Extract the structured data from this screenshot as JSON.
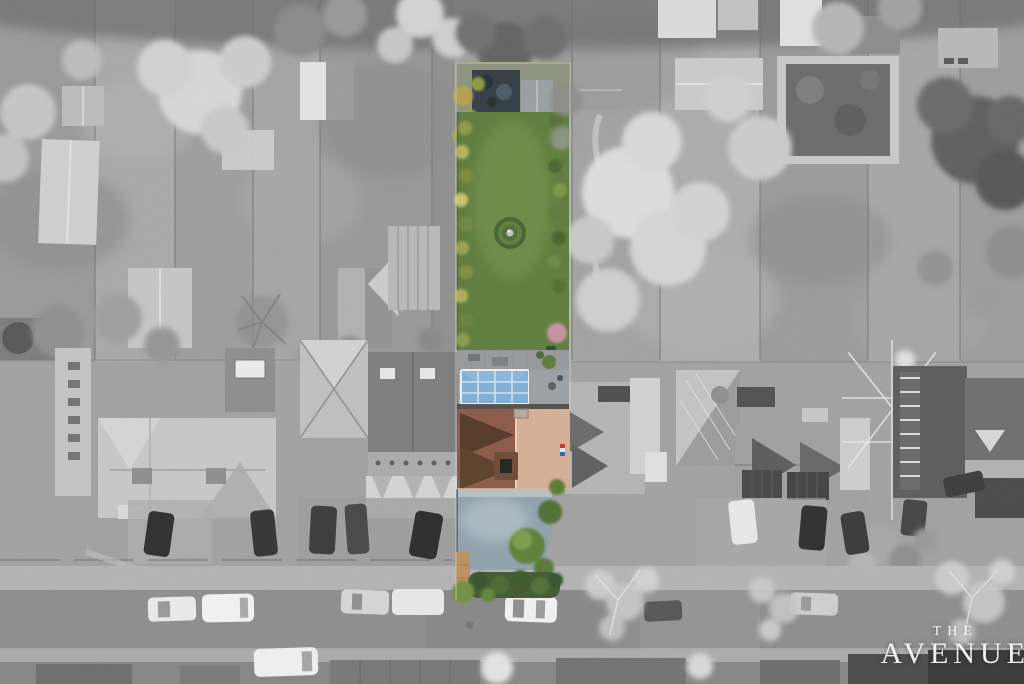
{
  "meta": {
    "type": "aerial-drone-photograph",
    "style": "selective-colour listing photo",
    "description": "Top-down winter aerial photo of a residential street. Everything is desaturated greyscale except one highlighted property: a long narrow plot with rear shed, large green lawn with circular flower bed, patio, blue-glazed conservatory, terracotta-roofed house, blue-grey driveway and front hedge, ending at the road with parked cars.",
    "width": 1024,
    "height": 684
  },
  "watermark": {
    "line1": "THE",
    "line2": "AVENUE"
  },
  "palette": {
    "mono_base": "#a2a2a2",
    "road": "#8e8e8e",
    "pavement": "#b4b4b4",
    "lawn": "#5e7d3c",
    "lawn_light": "#74924c",
    "hedge": "#42592e",
    "bush": "#5d8038",
    "shrub_yellow": "#b5b15c",
    "roof_dark_gable": "#553828",
    "roof_shadow_side": "#8a5a46",
    "roof_sunlit_side": "#d6b096",
    "conservatory_glass": "#7fb0d6",
    "driveway": "#8ea2ae",
    "wood_fence": "#bb9160",
    "car_white": "#f2f2f2",
    "car_dark": "#2f2f2f",
    "tree_bright": "#d6d6d6",
    "tree_dark": "#636363"
  },
  "property": {
    "label": "highlighted property plot",
    "features": "rear shed and patio, long lawn, circular flower bed with birdbath, conservatory, main house, driveway, front hedge"
  }
}
